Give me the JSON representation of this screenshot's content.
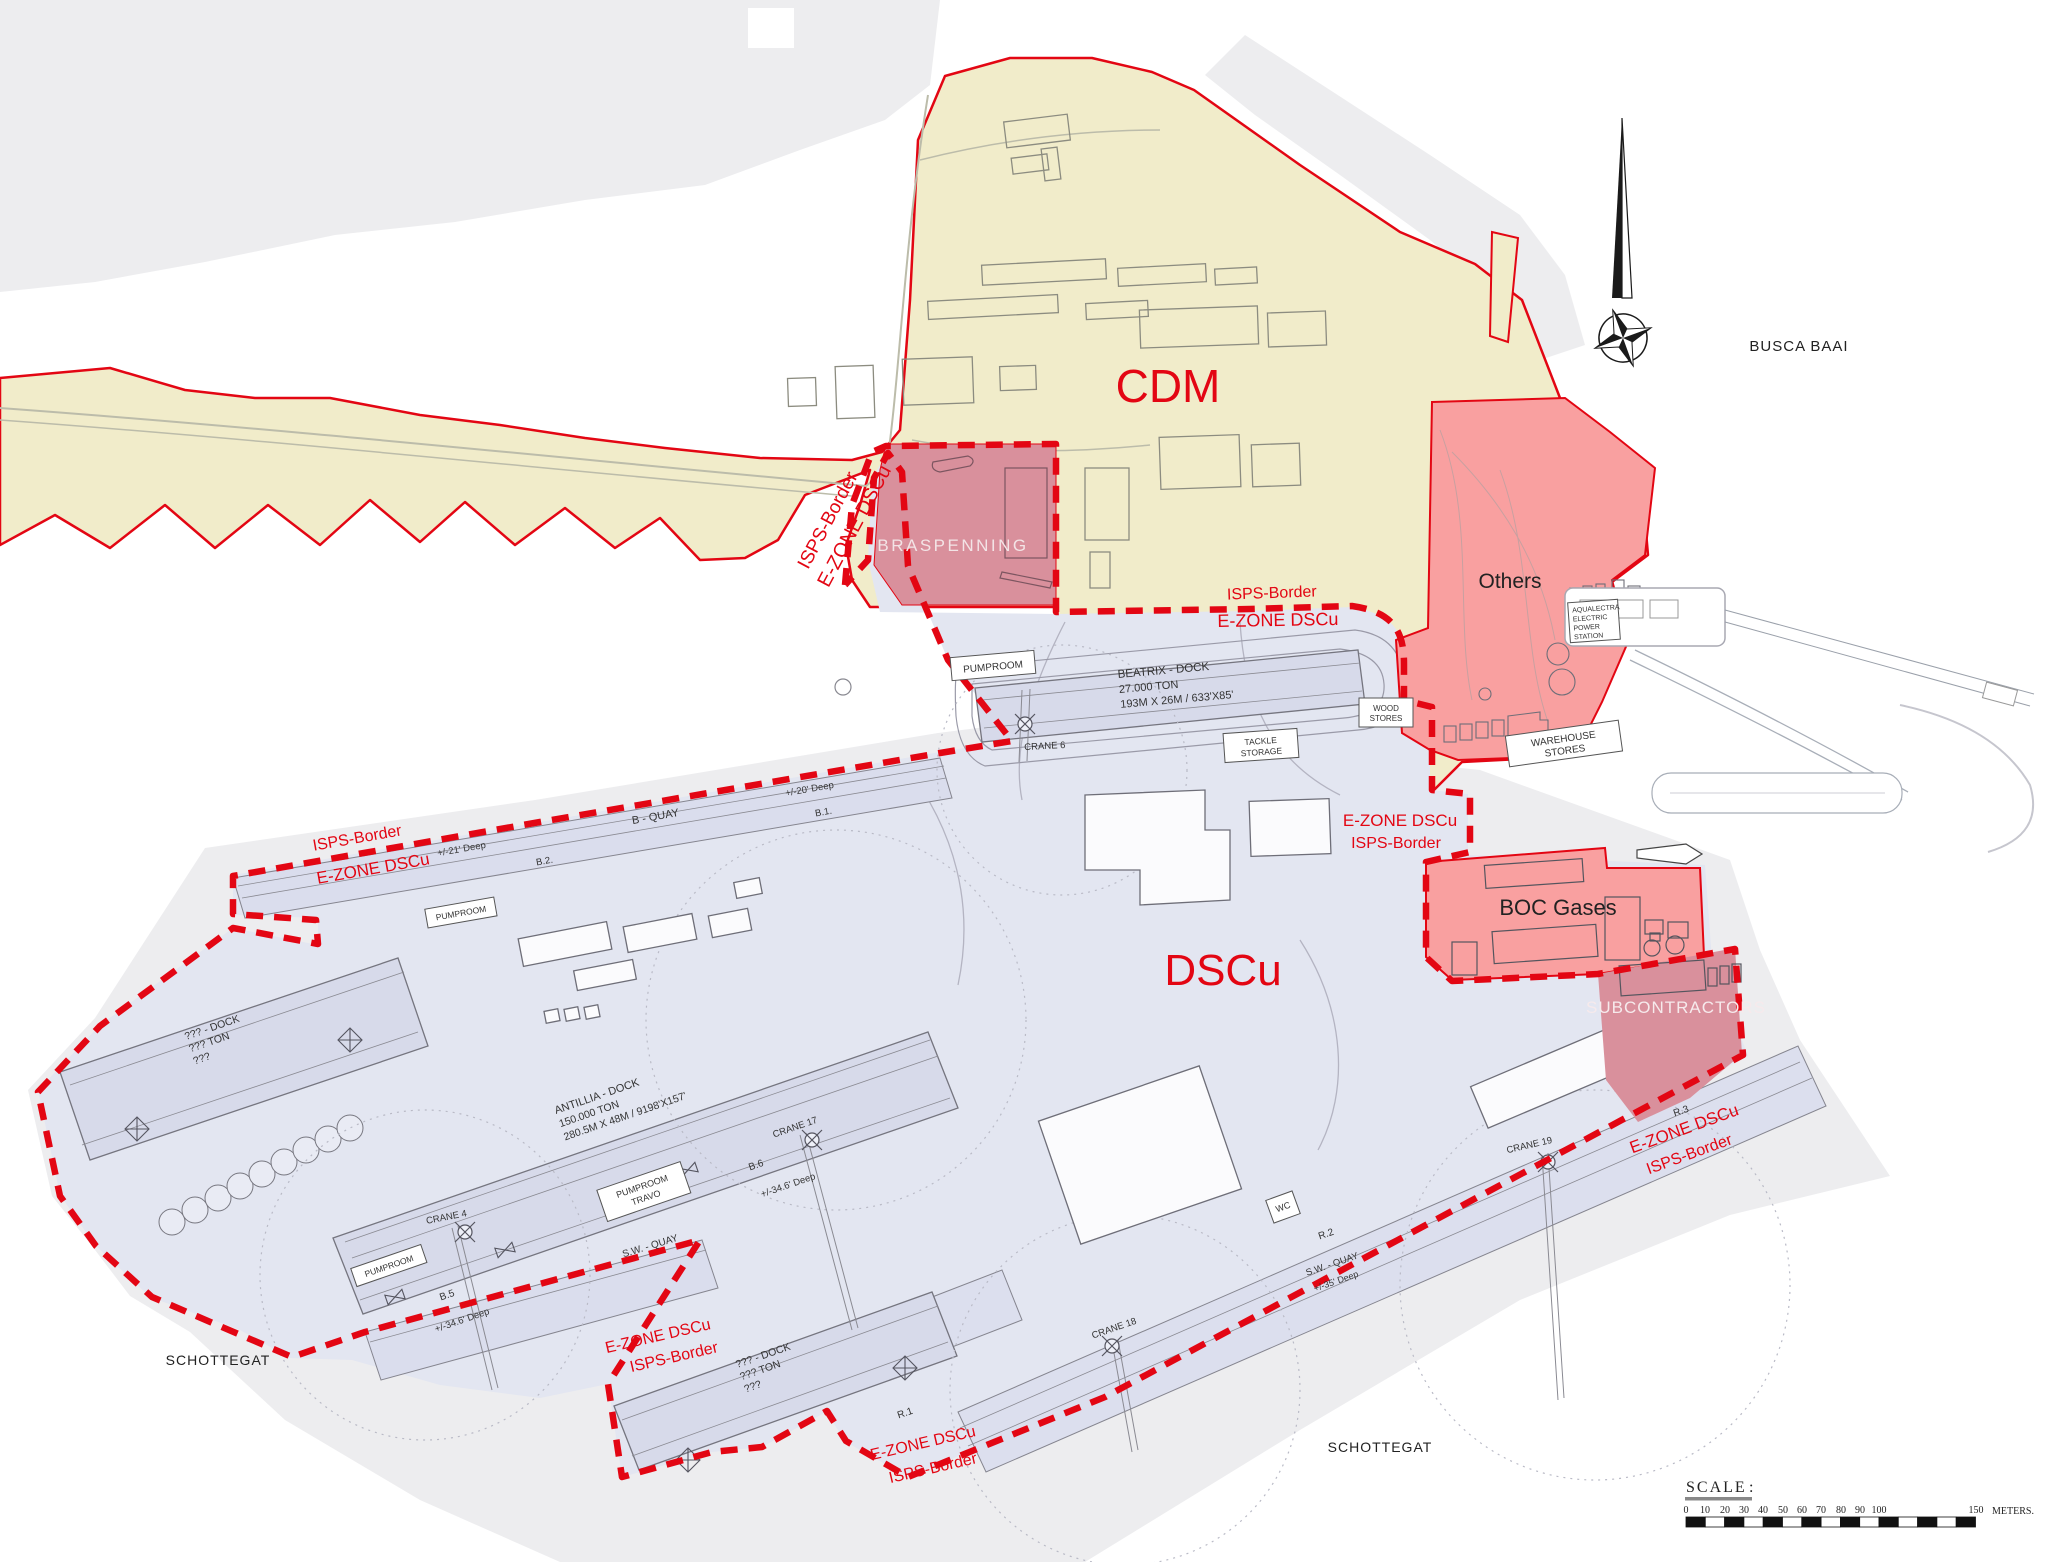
{
  "zones": {
    "cdm": "CDM",
    "dscu": "DSCu",
    "braspenning": "BRASPENNING",
    "others": "Others",
    "boc": "BOC Gases",
    "subcontractors": "SUBCONTRACTORS"
  },
  "water": {
    "busca_baai": "BUSCA BAAI",
    "schottegat": "SCHOTTEGAT"
  },
  "borders": {
    "isps": "ISPS-Border",
    "ezone": "E-ZONE DSCu"
  },
  "docks": {
    "beatrix": {
      "name": "BEATRIX - DOCK",
      "ton": "27.000 TON",
      "dim": "193M X 26M / 633'X85'"
    },
    "antillia": {
      "name": "ANTILLIA - DOCK",
      "ton": "150.000 TON",
      "dim": "280.5M X 48M / 9198'X157'"
    },
    "unknown": {
      "name": "??? - DOCK",
      "ton": "??? TON",
      "dim": "???"
    }
  },
  "quays": {
    "b_quay": "B - QUAY",
    "sw_quay": "S.W. - QUAY",
    "b1": "B.1.",
    "b2": "B.2.",
    "b5": "B.5",
    "b6": "B.6",
    "r1": "R.1",
    "r2": "R.2",
    "r3": "R.3",
    "deep20": "+/-20' Deep",
    "deep21": "+/-21' Deep",
    "deep34": "+/-34.6' Deep",
    "deep35": "+/-35' Deep"
  },
  "cranes": {
    "c4": "CRANE 4",
    "c6": "CRANE 6",
    "c17": "CRANE 17",
    "c18": "CRANE 18",
    "c19": "CRANE 19"
  },
  "facilities": {
    "pumproom": "PUMPROOM",
    "travo": "TRAVO",
    "tackle_l1": "TACKLE",
    "tackle_l2": "STORAGE",
    "wood_l1": "WOOD",
    "wood_l2": "STORES",
    "warehouse_l1": "WAREHOUSE",
    "warehouse_l2": "STORES",
    "aqualectra_l1": "AQUALECTRA",
    "aqualectra_l2": "ELECTRIC",
    "aqualectra_l3": "POWER",
    "aqualectra_l4": "STATION",
    "wc": "WC"
  },
  "scale_bar": {
    "title": "SCALE",
    "colon": ":",
    "ticks": [
      "0",
      "10",
      "20",
      "30",
      "40",
      "50",
      "60",
      "70",
      "80",
      "90",
      "100"
    ],
    "end": "150",
    "unit": "METERS."
  },
  "colors": {
    "cdm_fill": "#f1ecca",
    "dscu_fill": "#e3e6f1",
    "dock_fill": "#d7daea",
    "zone_salmon": "#f9a0a0",
    "zone_rose": "#d9909c",
    "border_red": "#e30613",
    "context_gray": "#ededef"
  }
}
